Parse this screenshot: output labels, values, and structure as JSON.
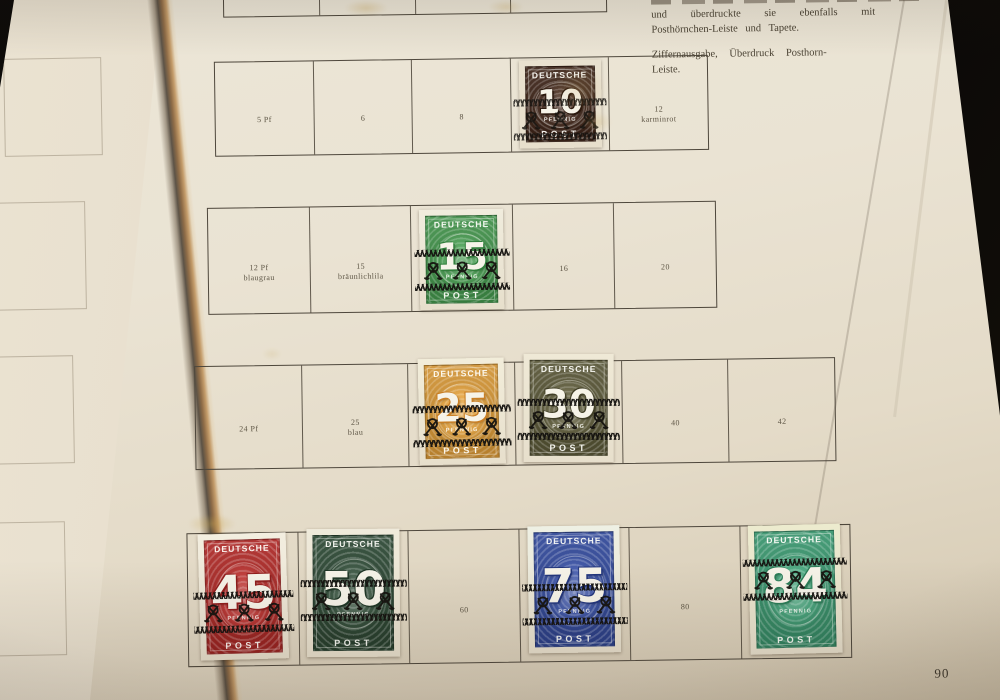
{
  "album_page": {
    "page_number": "90",
    "intro": {
      "line1": "und überdruckte sie ebenfalls mit",
      "line2": "Posthörnchen-Leiste und Tapete.",
      "heading1": "Ziffernausgabe, Überdruck Posthorn-",
      "heading2": "Leiste."
    }
  },
  "stamp_common": {
    "country": "DEUTSCHE",
    "post": "POST",
    "unit": "PFENNIG"
  },
  "stamps": {
    "pf10": {
      "value": "10",
      "base": "#45281a",
      "shade": "#2a170c",
      "paper": "#e9e1cf"
    },
    "pf15": {
      "value": "15",
      "base": "#48a452",
      "shade": "#2f7d3a",
      "paper": "#f0ecdd"
    },
    "pf25": {
      "value": "25",
      "base": "#f0a83a",
      "shade": "#c97f25",
      "paper": "#f2edda"
    },
    "pf30": {
      "value": "30",
      "base": "#625f3b",
      "shade": "#413f27",
      "paper": "#efe9d6"
    },
    "pf45": {
      "value": "45",
      "base": "#c52b28",
      "shade": "#8f1d1c",
      "paper": "#f3eee0"
    },
    "pf50": {
      "value": "50",
      "base": "#2f4f38",
      "shade": "#1d3424",
      "paper": "#efeadb"
    },
    "pf75": {
      "value": "75",
      "base": "#3550ae",
      "shade": "#22357c",
      "paper": "#eef0e4"
    },
    "pf84": {
      "value": "84",
      "base": "#3ea97b",
      "shade": "#2a7c57",
      "paper": "#ecebce"
    }
  },
  "rows": [
    {
      "name": "top-partial",
      "cells": [
        {},
        {},
        {},
        {}
      ]
    },
    {
      "name": "values-5-12",
      "cells": [
        {
          "label": [
            "5 Pf"
          ]
        },
        {
          "label": [
            "6"
          ]
        },
        {
          "label": [
            "8"
          ]
        },
        {
          "stamp": "pf10"
        },
        {
          "label": [
            "12",
            "karminrot"
          ]
        }
      ]
    },
    {
      "name": "values-12-20",
      "cells": [
        {
          "label": [
            "12 Pf",
            "blaugrau"
          ]
        },
        {
          "label": [
            "15",
            "bräunlichlila"
          ]
        },
        {
          "stamp": "pf15"
        },
        {
          "label": [
            "16"
          ]
        },
        {
          "label": [
            "20"
          ]
        }
      ]
    },
    {
      "name": "values-24-42",
      "cells": [
        {
          "label": [
            "24 Pf"
          ]
        },
        {
          "label": [
            "25",
            "blau"
          ]
        },
        {
          "stamp": "pf25"
        },
        {
          "stamp": "pf30"
        },
        {
          "label": [
            "40"
          ]
        },
        {
          "label": [
            "42"
          ]
        }
      ]
    },
    {
      "name": "values-45-84",
      "cells": [
        {
          "stamp": "pf45"
        },
        {
          "stamp": "pf50"
        },
        {
          "label": [
            "60"
          ]
        },
        {
          "stamp": "pf75"
        },
        {
          "label": [
            "80"
          ]
        },
        {
          "stamp": "pf84"
        }
      ]
    }
  ]
}
